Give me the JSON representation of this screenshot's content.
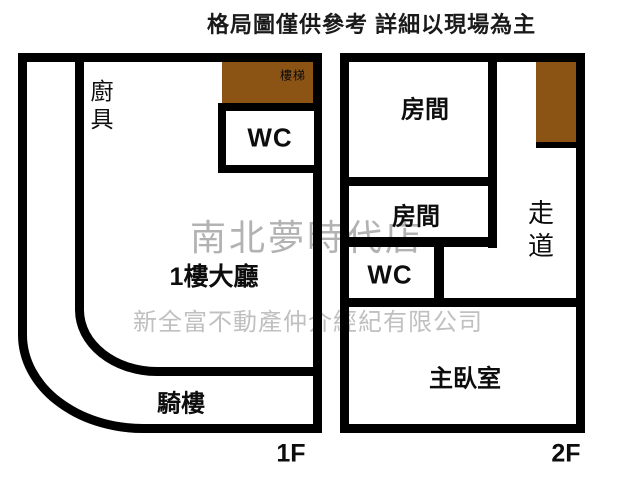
{
  "title": "格局圖僅供參考 詳細以現場為主",
  "watermarks": {
    "store": "南北夢時代店",
    "company": "新全富不動產仲介經紀有限公司"
  },
  "floor1": {
    "label": "1F",
    "kitchen": "廚具",
    "stairs": "樓梯",
    "wc": "WC",
    "hall": "1樓大廳",
    "arcade": "騎樓"
  },
  "floor2": {
    "label": "2F",
    "room_top": "房間",
    "room_middle": "房間",
    "corridor": "走道",
    "wc": "WC",
    "master_bedroom": "主臥室"
  },
  "colors": {
    "wall": "#000000",
    "stairs_fill": "#8c5414",
    "watermark_store": "#b2b2b2",
    "watermark_company": "#c0c0c0",
    "background": "#ffffff",
    "text": "#0d0d0d"
  }
}
